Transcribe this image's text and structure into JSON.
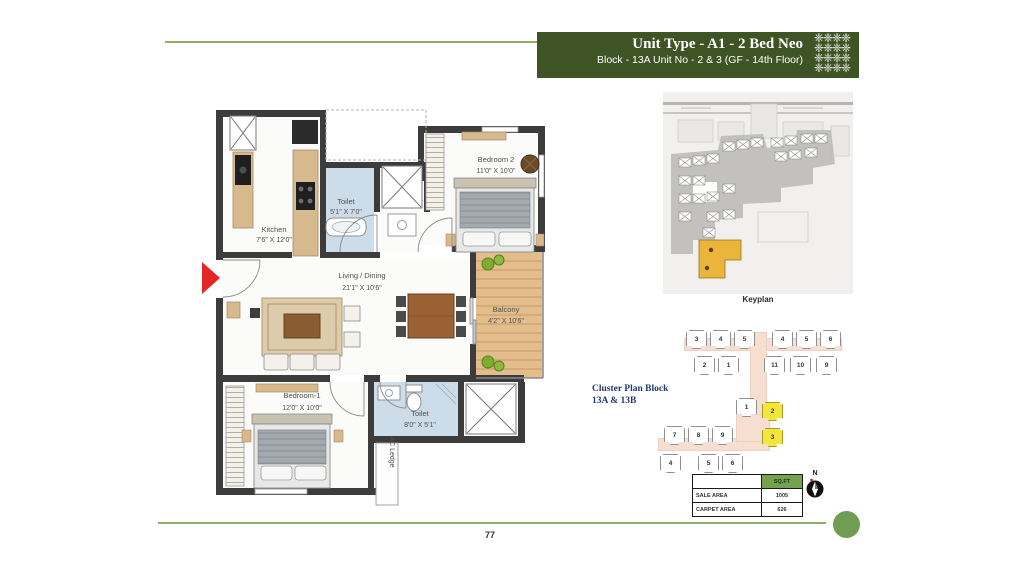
{
  "theme": {
    "banner_green": "#3e5424",
    "line_green": "#8fae66",
    "table_header_green": "#76a24f",
    "cluster_highlight": "#f2e63e",
    "keyplan_highlight": "#e9b63b",
    "navy": "#1e3a6e",
    "dot_green": "#6f9e53",
    "entry_arrow_red": "#e32726"
  },
  "header": {
    "title": "Unit Type - A1 - 2 Bed Neo",
    "subtitle": "Block - 13A Unit No - 2 & 3 (GF - 14th Floor)",
    "ornament_glyph": "❈"
  },
  "floorplan": {
    "rooms": [
      {
        "name": "Kitchen",
        "dims": "7'6\" X 12'0\""
      },
      {
        "name": "Toilet",
        "dims": "5'1\" X 7'0\""
      },
      {
        "name": "Bedroom 2",
        "dims": "11'0\" X 10'0\""
      },
      {
        "name": "Living / Dining",
        "dims": "21'1\" X 10'6\""
      },
      {
        "name": "Balcony",
        "dims": "4'2\" X 10'6\""
      },
      {
        "name": "Bedroom-1",
        "dims": "12'0\" X 10'0\""
      },
      {
        "name": "Toilet",
        "dims": "8'0\" X 5'1\""
      },
      {
        "name": "AC Ledge",
        "dims": ""
      }
    ]
  },
  "keyplan": {
    "label": "Keyplan"
  },
  "cluster_plan": {
    "label_line1": "Cluster Plan Block",
    "label_line2": "13A & 13B",
    "units": [
      {
        "n": "3"
      },
      {
        "n": "4"
      },
      {
        "n": "5"
      },
      {
        "n": "4"
      },
      {
        "n": "5"
      },
      {
        "n": "6"
      },
      {
        "n": "2"
      },
      {
        "n": "1"
      },
      {
        "n": "11"
      },
      {
        "n": "10"
      },
      {
        "n": "9"
      },
      {
        "n": "1"
      },
      {
        "n": "2",
        "hl": true
      },
      {
        "n": "3",
        "hl": true
      },
      {
        "n": "7"
      },
      {
        "n": "8"
      },
      {
        "n": "9"
      },
      {
        "n": "4"
      },
      {
        "n": "5"
      },
      {
        "n": "6"
      }
    ]
  },
  "area_table": {
    "unit_header": "SQ.FT",
    "rows": [
      {
        "label": "SALE AREA",
        "value": "1005"
      },
      {
        "label": "CARPET AREA",
        "value": "626"
      }
    ]
  },
  "compass": {
    "label": "N"
  },
  "footer": {
    "page_number": "77"
  }
}
